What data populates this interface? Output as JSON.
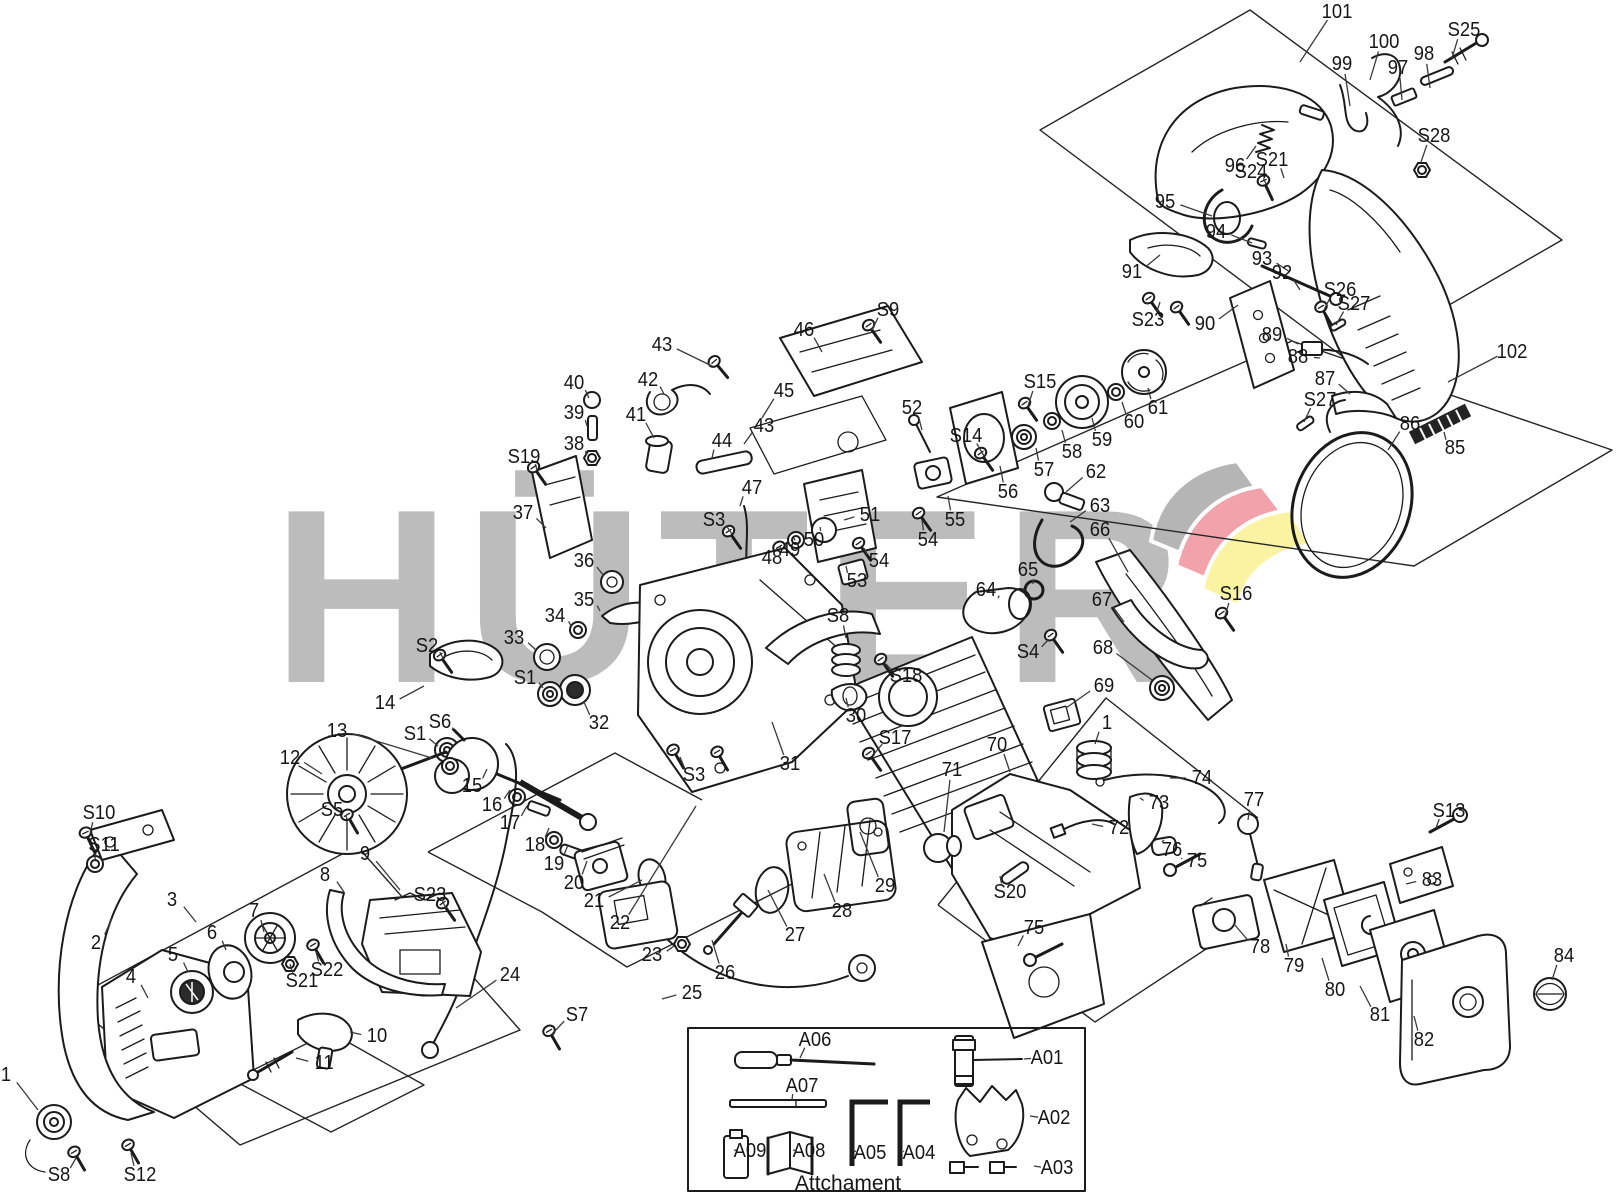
{
  "title": "Chainsaw exploded parts diagram",
  "watermark": {
    "text": "HÜTER",
    "color": "#bcbcbc",
    "flag_gray": "#b5b5b5",
    "flag_red": "#f2a2aa",
    "flag_yellow": "#f9f3a2"
  },
  "attachment_box": {
    "title": "Attchament"
  },
  "diagram": {
    "label_color": "#161616",
    "leader_color": "#3a3a3a",
    "labels": [
      {
        "t": "101",
        "x": 1337,
        "y": 12,
        "e": [
          1300,
          62
        ]
      },
      {
        "t": "100",
        "x": 1384,
        "y": 42,
        "e": [
          1370,
          80
        ]
      },
      {
        "t": "99",
        "x": 1342,
        "y": 64,
        "e": [
          1350,
          106
        ]
      },
      {
        "t": "97",
        "x": 1398,
        "y": 68,
        "e": [
          1402,
          100
        ]
      },
      {
        "t": "98",
        "x": 1424,
        "y": 54,
        "e": [
          1430,
          88
        ]
      },
      {
        "t": "S25",
        "x": 1464,
        "y": 30,
        "e": [
          1452,
          58
        ]
      },
      {
        "t": "S28",
        "x": 1434,
        "y": 136,
        "e": [
          1421,
          162
        ]
      },
      {
        "t": "96",
        "x": 1235,
        "y": 166,
        "e": [
          1256,
          146
        ]
      },
      {
        "t": "S24",
        "x": 1251,
        "y": 172,
        "e": [
          1266,
          184
        ]
      },
      {
        "t": "S21",
        "x": 1272,
        "y": 160,
        "e": [
          1284,
          178
        ]
      },
      {
        "t": "95",
        "x": 1165,
        "y": 202,
        "e": [
          1212,
          216
        ]
      },
      {
        "t": "94",
        "x": 1216,
        "y": 232,
        "e": [
          1252,
          243
        ]
      },
      {
        "t": "93",
        "x": 1262,
        "y": 259,
        "e": [
          1290,
          272
        ]
      },
      {
        "t": "92",
        "x": 1282,
        "y": 273,
        "e": [
          1300,
          290
        ]
      },
      {
        "t": "S26",
        "x": 1340,
        "y": 290,
        "e": [
          1324,
          310
        ]
      },
      {
        "t": "S27",
        "x": 1354,
        "y": 304,
        "e": [
          1336,
          325
        ]
      },
      {
        "t": "91",
        "x": 1132,
        "y": 272,
        "e": [
          1160,
          255
        ]
      },
      {
        "t": "S23",
        "x": 1148,
        "y": 320,
        "e": [
          1160,
          302
        ]
      },
      {
        "t": "90",
        "x": 1205,
        "y": 324,
        "e": [
          1238,
          305
        ]
      },
      {
        "t": "89",
        "x": 1272,
        "y": 335,
        "e": [
          1298,
          344
        ]
      },
      {
        "t": "88",
        "x": 1298,
        "y": 357,
        "e": [
          1320,
          358
        ]
      },
      {
        "t": "87",
        "x": 1325,
        "y": 379,
        "e": [
          1350,
          394
        ]
      },
      {
        "t": "102",
        "x": 1512,
        "y": 352,
        "e": [
          1448,
          382
        ]
      },
      {
        "t": "S27",
        "x": 1320,
        "y": 400,
        "e": [
          1304,
          422
        ]
      },
      {
        "t": "86",
        "x": 1410,
        "y": 424,
        "e": [
          1388,
          450
        ]
      },
      {
        "t": "85",
        "x": 1455,
        "y": 448,
        "e": [
          1444,
          432
        ]
      },
      {
        "t": "52",
        "x": 912,
        "y": 408,
        "e": [
          922,
          430
        ]
      },
      {
        "t": "S14",
        "x": 966,
        "y": 436,
        "e": [
          984,
          456
        ]
      },
      {
        "t": "S15",
        "x": 1040,
        "y": 382,
        "e": [
          1028,
          406
        ]
      },
      {
        "t": "55",
        "x": 955,
        "y": 520,
        "e": [
          948,
          496
        ]
      },
      {
        "t": "54",
        "x": 928,
        "y": 540,
        "e": [
          922,
          520
        ]
      },
      {
        "t": "56",
        "x": 1008,
        "y": 492,
        "e": [
          1000,
          466
        ]
      },
      {
        "t": "57",
        "x": 1044,
        "y": 470,
        "e": [
          1036,
          448
        ]
      },
      {
        "t": "58",
        "x": 1072,
        "y": 452,
        "e": [
          1062,
          430
        ]
      },
      {
        "t": "59",
        "x": 1102,
        "y": 440,
        "e": [
          1092,
          418
        ]
      },
      {
        "t": "60",
        "x": 1134,
        "y": 422,
        "e": [
          1122,
          402
        ]
      },
      {
        "t": "61",
        "x": 1158,
        "y": 408,
        "e": [
          1148,
          388
        ]
      },
      {
        "t": "62",
        "x": 1096,
        "y": 472,
        "e": [
          1066,
          492
        ]
      },
      {
        "t": "63",
        "x": 1100,
        "y": 506,
        "e": [
          1070,
          522
        ]
      },
      {
        "t": "64",
        "x": 986,
        "y": 590,
        "e": [
          998,
          598
        ]
      },
      {
        "t": "65",
        "x": 1028,
        "y": 570,
        "e": [
          1033,
          584
        ]
      },
      {
        "t": "S4",
        "x": 1028,
        "y": 652,
        "e": [
          1048,
          640
        ]
      },
      {
        "t": "66",
        "x": 1100,
        "y": 530,
        "e": [
          1128,
          572
        ]
      },
      {
        "t": "67",
        "x": 1102,
        "y": 600,
        "e": [
          1124,
          622
        ]
      },
      {
        "t": "68",
        "x": 1103,
        "y": 648,
        "e": [
          1152,
          680
        ]
      },
      {
        "t": "69",
        "x": 1104,
        "y": 686,
        "e": [
          1066,
          708
        ]
      },
      {
        "t": "S16",
        "x": 1236,
        "y": 594,
        "e": [
          1225,
          616
        ]
      },
      {
        "t": "S9",
        "x": 888,
        "y": 310,
        "e": [
          872,
          330
        ]
      },
      {
        "t": "46",
        "x": 804,
        "y": 330,
        "e": [
          822,
          352
        ]
      },
      {
        "t": "43",
        "x": 662,
        "y": 345,
        "e": [
          712,
          366
        ]
      },
      {
        "t": "42",
        "x": 648,
        "y": 380,
        "e": [
          664,
          394
        ]
      },
      {
        "t": "41",
        "x": 636,
        "y": 415,
        "e": [
          654,
          438
        ]
      },
      {
        "t": "40",
        "x": 574,
        "y": 383,
        "e": [
          589,
          398
        ]
      },
      {
        "t": "39",
        "x": 574,
        "y": 413,
        "e": [
          587,
          426
        ]
      },
      {
        "t": "38",
        "x": 574,
        "y": 444,
        "e": [
          586,
          455
        ]
      },
      {
        "t": "S19",
        "x": 524,
        "y": 457,
        "e": [
          537,
          470
        ]
      },
      {
        "t": "37",
        "x": 523,
        "y": 513,
        "e": [
          546,
          528
        ]
      },
      {
        "t": "36",
        "x": 584,
        "y": 561,
        "e": [
          604,
          576
        ]
      },
      {
        "t": "35",
        "x": 584,
        "y": 600,
        "e": [
          600,
          611
        ]
      },
      {
        "t": "34",
        "x": 555,
        "y": 616,
        "e": [
          571,
          626
        ]
      },
      {
        "t": "33",
        "x": 514,
        "y": 638,
        "e": [
          536,
          650
        ]
      },
      {
        "t": "S2",
        "x": 427,
        "y": 646,
        "e": [
          443,
          658
        ]
      },
      {
        "t": "S1",
        "x": 525,
        "y": 678,
        "e": [
          543,
          688
        ]
      },
      {
        "t": "14",
        "x": 385,
        "y": 703,
        "e": [
          424,
          686
        ]
      },
      {
        "t": "S6",
        "x": 440,
        "y": 722,
        "e": [
          452,
          730
        ]
      },
      {
        "t": "S1",
        "x": 415,
        "y": 734,
        "e": [
          438,
          746
        ]
      },
      {
        "t": "13",
        "x": 337,
        "y": 731,
        "e": [
          432,
          758
        ]
      },
      {
        "t": "12",
        "x": 290,
        "y": 758,
        "e": [
          322,
          774
        ]
      },
      {
        "t": "S5",
        "x": 332,
        "y": 810,
        "e": [
          347,
          819
        ]
      },
      {
        "t": "15",
        "x": 472,
        "y": 786,
        "e": [
          487,
          769
        ]
      },
      {
        "t": "16",
        "x": 492,
        "y": 805,
        "e": [
          510,
          790
        ]
      },
      {
        "t": "17",
        "x": 510,
        "y": 823,
        "e": [
          527,
          806
        ]
      },
      {
        "t": "18",
        "x": 535,
        "y": 845,
        "e": [
          549,
          828
        ]
      },
      {
        "t": "19",
        "x": 554,
        "y": 864,
        "e": [
          568,
          845
        ]
      },
      {
        "t": "20",
        "x": 574,
        "y": 883,
        "e": [
          587,
          861
        ]
      },
      {
        "t": "21",
        "x": 594,
        "y": 901,
        "e": [
          642,
          880
        ]
      },
      {
        "t": "22",
        "x": 620,
        "y": 923,
        "e": [
          696,
          806
        ]
      },
      {
        "t": "23",
        "x": 652,
        "y": 955,
        "e": [
          674,
          946
        ]
      },
      {
        "t": "24",
        "x": 510,
        "y": 975,
        "e": [
          456,
          1008
        ]
      },
      {
        "t": "S7",
        "x": 577,
        "y": 1015,
        "e": [
          552,
          1034
        ]
      },
      {
        "t": "25",
        "x": 692,
        "y": 993,
        "e": [
          662,
          999
        ]
      },
      {
        "t": "26",
        "x": 725,
        "y": 973,
        "e": [
          712,
          940
        ]
      },
      {
        "t": "27",
        "x": 795,
        "y": 935,
        "e": [
          768,
          890
        ]
      },
      {
        "t": "28",
        "x": 842,
        "y": 911,
        "e": [
          824,
          874
        ]
      },
      {
        "t": "29",
        "x": 885,
        "y": 886,
        "e": [
          860,
          832
        ]
      },
      {
        "t": "30",
        "x": 856,
        "y": 716,
        "e": [
          846,
          698
        ]
      },
      {
        "t": "31",
        "x": 790,
        "y": 764,
        "e": [
          772,
          722
        ]
      },
      {
        "t": "S17",
        "x": 895,
        "y": 738,
        "e": [
          874,
          754
        ]
      },
      {
        "t": "S3",
        "x": 694,
        "y": 775,
        "e": [
          680,
          757
        ]
      },
      {
        "t": "S3",
        "x": 714,
        "y": 520,
        "e": [
          732,
          534
        ]
      },
      {
        "t": "S8",
        "x": 838,
        "y": 616,
        "e": [
          846,
          638
        ]
      },
      {
        "t": "S18",
        "x": 906,
        "y": 676,
        "e": [
          886,
          664
        ]
      },
      {
        "t": "44",
        "x": 722,
        "y": 441,
        "e": [
          712,
          458
        ]
      },
      {
        "t": "43",
        "x": 764,
        "y": 426,
        "e": [
          744,
          444
        ]
      },
      {
        "t": "45",
        "x": 784,
        "y": 391,
        "e": [
          762,
          418
        ]
      },
      {
        "t": "47",
        "x": 752,
        "y": 488,
        "e": [
          740,
          506
        ]
      },
      {
        "t": "48",
        "x": 772,
        "y": 558,
        "e": [
          780,
          546
        ]
      },
      {
        "t": "49",
        "x": 790,
        "y": 550,
        "e": [
          794,
          538
        ]
      },
      {
        "t": "50",
        "x": 814,
        "y": 540,
        "e": [
          820,
          527
        ]
      },
      {
        "t": "51",
        "x": 870,
        "y": 515,
        "e": [
          844,
          520
        ]
      },
      {
        "t": "53",
        "x": 857,
        "y": 581,
        "e": [
          846,
          566
        ]
      },
      {
        "t": "54",
        "x": 879,
        "y": 561,
        "e": [
          864,
          548
        ]
      },
      {
        "t": "32",
        "x": 599,
        "y": 723,
        "e": [
          584,
          702
        ]
      },
      {
        "t": "S23",
        "x": 430,
        "y": 895,
        "e": [
          446,
          908
        ]
      },
      {
        "t": "S10",
        "x": 99,
        "y": 813,
        "e": [
          90,
          834
        ]
      },
      {
        "t": "S11",
        "x": 104,
        "y": 845,
        "e": [
          95,
          860
        ]
      },
      {
        "t": "2",
        "x": 96,
        "y": 943,
        "e": [
          112,
          918
        ]
      },
      {
        "t": "3",
        "x": 172,
        "y": 900,
        "e": [
          196,
          922
        ]
      },
      {
        "t": "7",
        "x": 254,
        "y": 911,
        "e": [
          264,
          932
        ]
      },
      {
        "t": "6",
        "x": 212,
        "y": 933,
        "e": [
          226,
          950
        ]
      },
      {
        "t": "5",
        "x": 173,
        "y": 955,
        "e": [
          188,
          972
        ]
      },
      {
        "t": "4",
        "x": 131,
        "y": 977,
        "e": [
          148,
          998
        ]
      },
      {
        "t": "9",
        "x": 365,
        "y": 854,
        "e": [
          400,
          890
        ]
      },
      {
        "t": "8",
        "x": 325,
        "y": 875,
        "e": [
          344,
          892
        ]
      },
      {
        "t": "S22",
        "x": 327,
        "y": 970,
        "e": [
          316,
          952
        ]
      },
      {
        "t": "S21",
        "x": 302,
        "y": 981,
        "e": [
          290,
          964
        ]
      },
      {
        "t": "10",
        "x": 377,
        "y": 1036,
        "e": [
          350,
          1032
        ]
      },
      {
        "t": "11",
        "x": 324,
        "y": 1063,
        "e": [
          296,
          1058
        ]
      },
      {
        "t": "1",
        "x": 6,
        "y": 1075,
        "e": [
          38,
          1110
        ]
      },
      {
        "t": "S8",
        "x": 59,
        "y": 1175,
        "e": [
          76,
          1158
        ]
      },
      {
        "t": "S12",
        "x": 140,
        "y": 1175,
        "e": [
          131,
          1153
        ]
      },
      {
        "t": "70",
        "x": 997,
        "y": 745,
        "e": [
          1010,
          772
        ]
      },
      {
        "t": "71",
        "x": 952,
        "y": 770,
        "e": [
          944,
          832
        ]
      },
      {
        "t": "1",
        "x": 1107,
        "y": 723,
        "e": [
          1095,
          744
        ]
      },
      {
        "t": "74",
        "x": 1202,
        "y": 778,
        "e": [
          1170,
          778
        ]
      },
      {
        "t": "73",
        "x": 1159,
        "y": 803,
        "e": [
          1140,
          798
        ]
      },
      {
        "t": "72",
        "x": 1119,
        "y": 828,
        "e": [
          1092,
          824
        ]
      },
      {
        "t": "77",
        "x": 1254,
        "y": 800,
        "e": [
          1248,
          820
        ]
      },
      {
        "t": "76",
        "x": 1172,
        "y": 850,
        "e": [
          1164,
          840
        ]
      },
      {
        "t": "75",
        "x": 1197,
        "y": 861,
        "e": [
          1182,
          858
        ]
      },
      {
        "t": "S20",
        "x": 1010,
        "y": 892,
        "e": [
          1000,
          876
        ]
      },
      {
        "t": "75",
        "x": 1034,
        "y": 928,
        "e": [
          1018,
          946
        ]
      },
      {
        "t": "78",
        "x": 1260,
        "y": 947,
        "e": [
          1234,
          924
        ]
      },
      {
        "t": "79",
        "x": 1294,
        "y": 966,
        "e": [
          1286,
          944
        ]
      },
      {
        "t": "80",
        "x": 1335,
        "y": 990,
        "e": [
          1322,
          958
        ]
      },
      {
        "t": "81",
        "x": 1380,
        "y": 1015,
        "e": [
          1360,
          986
        ]
      },
      {
        "t": "82",
        "x": 1424,
        "y": 1040,
        "e": [
          1414,
          1016
        ]
      },
      {
        "t": "83",
        "x": 1432,
        "y": 880,
        "e": [
          1406,
          884
        ]
      },
      {
        "t": "S13",
        "x": 1449,
        "y": 811,
        "e": [
          1436,
          828
        ]
      },
      {
        "t": "84",
        "x": 1564,
        "y": 956,
        "e": [
          1552,
          980
        ]
      },
      {
        "t": "A06",
        "x": 815,
        "y": 1040,
        "e": [
          800,
          1058
        ]
      },
      {
        "t": "A07",
        "x": 802,
        "y": 1086,
        "e": [
          792,
          1100
        ]
      },
      {
        "t": "A01",
        "x": 1047,
        "y": 1058,
        "e": [
          1024,
          1059
        ]
      },
      {
        "t": "A02",
        "x": 1054,
        "y": 1118,
        "e": [
          1030,
          1116
        ]
      },
      {
        "t": "A03",
        "x": 1057,
        "y": 1168,
        "e": [
          1034,
          1166
        ]
      },
      {
        "t": "A05",
        "x": 870,
        "y": 1153,
        "e": [
          856,
          1151
        ]
      },
      {
        "t": "A04",
        "x": 919,
        "y": 1153,
        "e": [
          904,
          1151
        ]
      },
      {
        "t": "A09",
        "x": 750,
        "y": 1151,
        "e": [
          737,
          1150
        ]
      },
      {
        "t": "A08",
        "x": 809,
        "y": 1151,
        "e": [
          795,
          1150
        ]
      }
    ]
  }
}
